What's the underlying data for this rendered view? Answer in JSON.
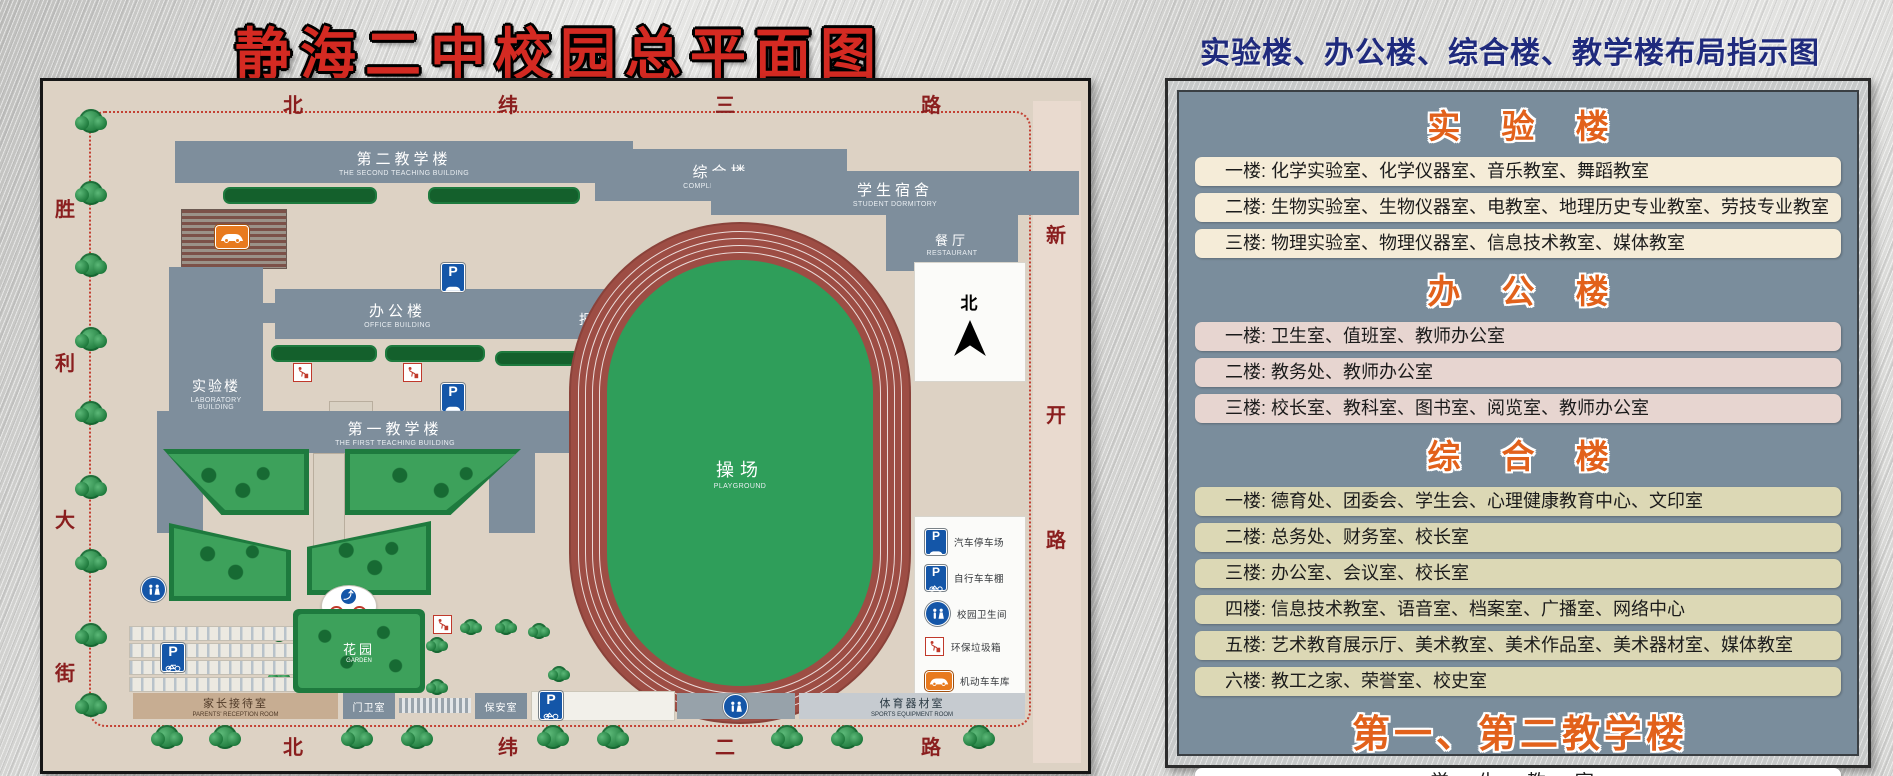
{
  "page_title": "静海二中校园总平面图",
  "colors": {
    "title_red": "#d42a22",
    "info_title_blue": "#1f2a7d",
    "heading_orange": "#e2611b",
    "panel_bg": "#7a8d9c",
    "map_bg": "#ddd2c4",
    "row_cream": "#f5ecd8",
    "row_pink": "#e7d5d0",
    "row_olive": "#dcd8b5",
    "track_red": "#9d4d44",
    "field_green": "#2f9e5a",
    "sign_blue": "#1456a8"
  },
  "map": {
    "roads": {
      "top": [
        "北",
        "纬",
        "三",
        "路"
      ],
      "bottom": [
        "北",
        "纬",
        "二",
        "路"
      ],
      "left": [
        "胜",
        "利",
        "大",
        "街"
      ],
      "right": [
        "新",
        "开",
        "路"
      ]
    },
    "buildings": {
      "second_teaching": {
        "zh": "第二教学楼",
        "en": "THE SECOND TEACHING BUILDING"
      },
      "complex": {
        "zh": "综合楼",
        "en": "COMPLEX BUILDING"
      },
      "dormitory": {
        "zh": "学生宿舍",
        "en": "STUDENT DORMITORY"
      },
      "restaurant": {
        "zh": "餐厅",
        "en": "RESTAURANT"
      },
      "office": {
        "zh": "办公楼",
        "en": "OFFICE BUILDING"
      },
      "auditorium": {
        "zh": "报告厅",
        "en": "AUDITORIUM"
      },
      "laboratory": {
        "zh": "实验楼",
        "en": "LABORATORY BUILDING"
      },
      "first_teaching": {
        "zh": "第一教学楼",
        "en": "THE FIRST TEACHING BUILDING"
      },
      "playground": {
        "zh": "操场",
        "en": "PLAYGROUND"
      },
      "garden": {
        "zh": "花园",
        "en": "GARDEN"
      },
      "parents_reception": {
        "zh": "家长接待室",
        "en": "PARENTS' RECEPTION ROOM"
      },
      "gate_room": {
        "zh": "门卫室"
      },
      "security_room": {
        "zh": "保安室"
      },
      "sports_equipment": {
        "zh": "体育器材室",
        "en": "SPORTS EQUIPMENT ROOM"
      }
    },
    "north_label": "北",
    "legend": {
      "items": [
        {
          "icon": "car-parking-icon",
          "label": "汽车停车场"
        },
        {
          "icon": "bicycle-shed-icon",
          "label": "自行车车棚"
        },
        {
          "icon": "campus-toilet-icon",
          "label": "校园卫生间"
        },
        {
          "icon": "trash-bin-icon",
          "label": "环保垃圾箱"
        },
        {
          "icon": "motor-garage-icon",
          "label": "机动车车库"
        }
      ]
    }
  },
  "info": {
    "title": "实验楼、办公楼、综合楼、教学楼布局指示图",
    "sections": [
      {
        "heading": "实 验 楼",
        "rows": [
          "一楼: 化学实验室、化学仪器室、音乐教室、舞蹈教室",
          "二楼: 生物实验室、生物仪器室、电教室、地理历史专业教室、劳技专业教室",
          "三楼: 物理实验室、物理仪器室、信息技术教室、媒体教室"
        ]
      },
      {
        "heading": "办 公 楼",
        "rows": [
          "一楼: 卫生室、值班室、教师办公室",
          "二楼: 教务处、教师办公室",
          "三楼: 校长室、教科室、图书室、阅览室、教师办公室"
        ]
      },
      {
        "heading": "综 合 楼",
        "rows": [
          "一楼: 德育处、团委会、学生会、心理健康教育中心、文印室",
          "二楼: 总务处、财务室、校长室",
          "三楼: 办公室、会议室、校长室",
          "四楼: 信息技术教室、语音室、档案室、广播室、网络中心",
          "五楼: 艺术教育展示厅、美术教室、美术作品室、美术器材室、媒体教室",
          "六楼: 教工之家、荣誉室、校史室"
        ]
      },
      {
        "heading": "第一、第二教学楼",
        "rows": [
          "学 生 教 室"
        ]
      }
    ]
  }
}
